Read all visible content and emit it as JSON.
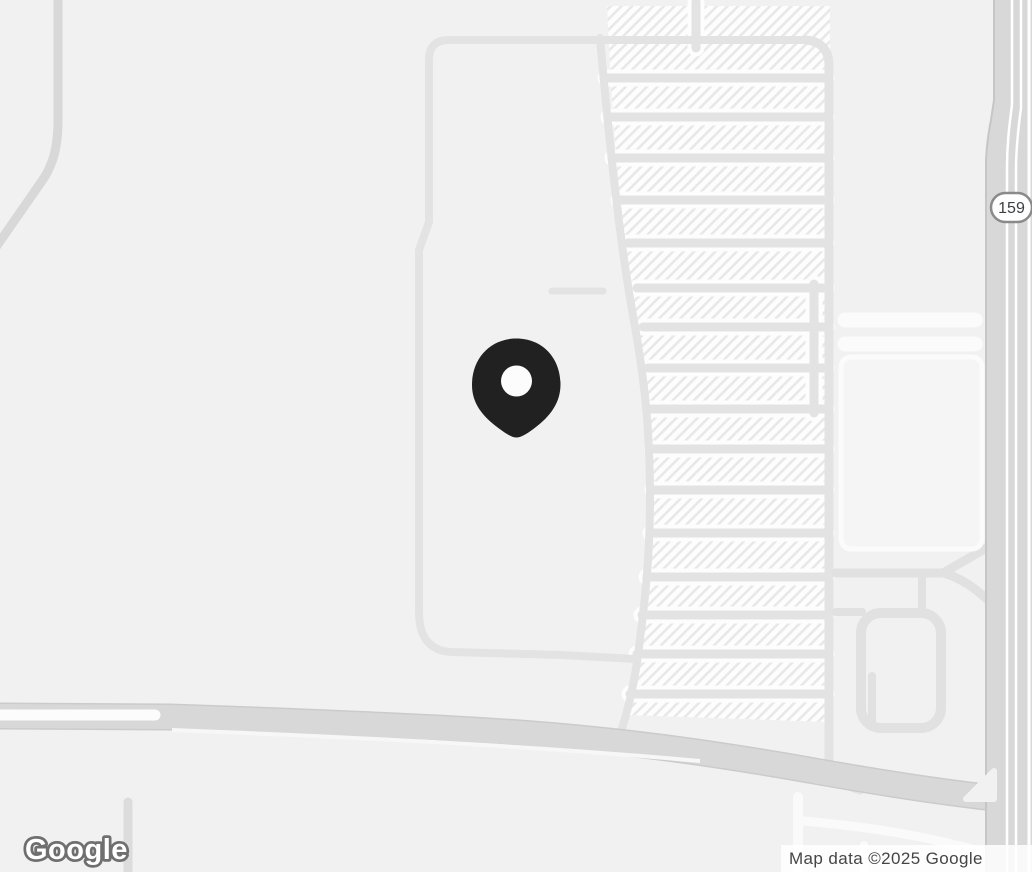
{
  "map": {
    "kind": "static-road-map",
    "logo": {
      "text": "Google"
    },
    "attribution": {
      "text": "Map data ©2025 Google"
    },
    "route_shield": {
      "label": "159"
    },
    "marker": {
      "description": "black location pin with white center dot",
      "x": 516,
      "y": 385
    },
    "colors": {
      "background": "#F1F1F1",
      "minor_road": "#E3E3E3",
      "white_road": "#FBFBFB",
      "major_road": "#D8D8D8",
      "major_road_casing": "#CBCBCB",
      "highway": "#D8D8D8",
      "highway_casing": "#C6C6C6",
      "block_underlay": "#FDFDFD",
      "hatch_stripe": "#E8E8E8",
      "pin_fill": "#212121",
      "pin_dot": "#FCFCFC",
      "shield_border": "#8A8A8A",
      "shield_text": "#3C4043",
      "attribution_text": "#454545",
      "logo_outline": "#6F6F6F"
    }
  }
}
